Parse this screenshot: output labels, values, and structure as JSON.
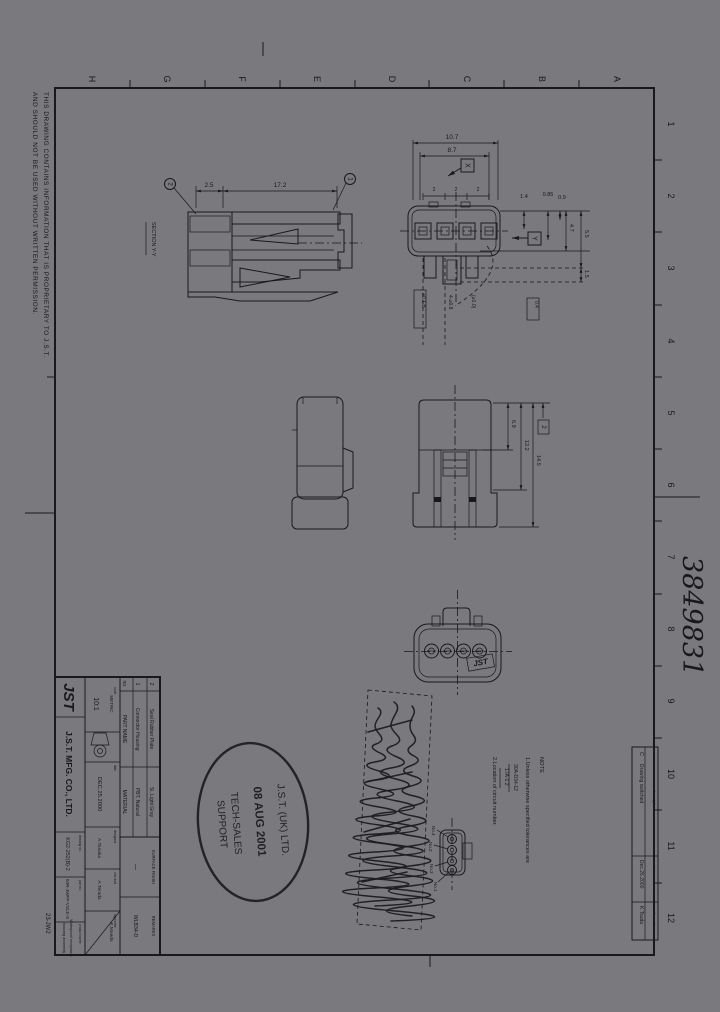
{
  "sheet": {
    "grid_letters": [
      "H",
      "G",
      "F",
      "E",
      "D",
      "C",
      "B",
      "A"
    ],
    "grid_numbers": [
      "1",
      "2",
      "3",
      "4",
      "5",
      "6",
      "7",
      "8",
      "9",
      "10",
      "11",
      "12"
    ],
    "proprietary_line1": "THIS DRAWING CONTAINS INFORMATION THAT IS PROPRIETARY TO J.S.T.",
    "proprietary_line2": "AND SHOULD NOT BE USED WITHOUT WRITTEN PERMISSION.",
    "handwritten_number": "3849831",
    "margin_code": "23-JW2"
  },
  "views": {
    "section": {
      "label": "SECTION Y-Y",
      "dim_seal": "2.5",
      "dim_length": "17.2",
      "balloon_seal": "2",
      "balloon_housing": "1"
    },
    "front": {
      "dim_width": "10.7",
      "dim_inner_width": "8.7",
      "pitch1": "2",
      "pitch2": "2",
      "pitch3": "2",
      "section_x": "X",
      "section_y": "Y",
      "dim_a": "1.4",
      "dim_b": "0.85",
      "dim_c": "0.9",
      "dim_d": "4.7",
      "dim_e": "5.5",
      "dim_f": "1.5",
      "dim_hole": "4-⌀0.8",
      "dim_hole2": "(⌀1.0)",
      "dim_tol": "⌀0.1 B",
      "dim_g": "0.4"
    },
    "top": {
      "dim_a": "6.9",
      "dim_b": "12.2",
      "dim_c": "14.5",
      "dim_ref": "2"
    },
    "rear": {
      "molded_logo": "JST"
    },
    "circuit": {
      "labels": [
        "No.4",
        "No.2",
        "No.3",
        "No.1"
      ]
    }
  },
  "notes": {
    "title": "NOTE",
    "line1": "1.Unless otherwise specified tolerances are",
    "ref1": "30A-D34-12",
    "ref2": "17A-1.2",
    "line2": "2.Location of circuit number."
  },
  "stamp": {
    "line1": "J.S.T. (UK) LTD.",
    "line2": "08 AUG 2001",
    "line3": "TECH-SALES",
    "line4": "SUPPORT"
  },
  "revision": {
    "rev_value": "C",
    "rev_label": "rev",
    "description": "Drawing switched",
    "description_label": "description",
    "date": "Dec.26.2000",
    "date_label": "date",
    "name": "K.Tsuda",
    "name_label": "confirmed"
  },
  "title_block": {
    "logo": "JST",
    "company": "J.S.T. MFG. CO., LTD.",
    "parts_header": {
      "no": "no.",
      "name": "PART NAME",
      "material": "MATERIAL"
    },
    "parts": [
      {
        "no": "1",
        "name": "Connector Housing",
        "material": "PBT, Natural"
      },
      {
        "no": "2",
        "name": "Seal Rubber Plate",
        "material": "Si, Light Gray"
      }
    ],
    "surface_finish_label": "SURFACE FINISH",
    "surface_finish_value": "—",
    "remarks_label": "REMARKS",
    "remarks_value": "WLB34-D",
    "unit_label": "unit",
    "unit_value": "METRIC",
    "scale_label": "scale",
    "scale_value": "10:1",
    "date_label": "date",
    "date_value": "DEC.25.2000",
    "designed_label": "designed",
    "designed_value": "A.Tanaka",
    "checked_label": "checked",
    "checked_value": "A.Terada",
    "approved_label": "approved",
    "approved_value": "K.Maeda",
    "drawing_no_label": "drawing no.",
    "drawing_no_value": "KG2-252(B)-2",
    "part_no_label": "part no.",
    "part_no_value": "04R-JWPF-VSLE-S",
    "product_label": "product name",
    "product_line1": "Waterproof receptacle",
    "product_line2": "housing assembly"
  }
}
